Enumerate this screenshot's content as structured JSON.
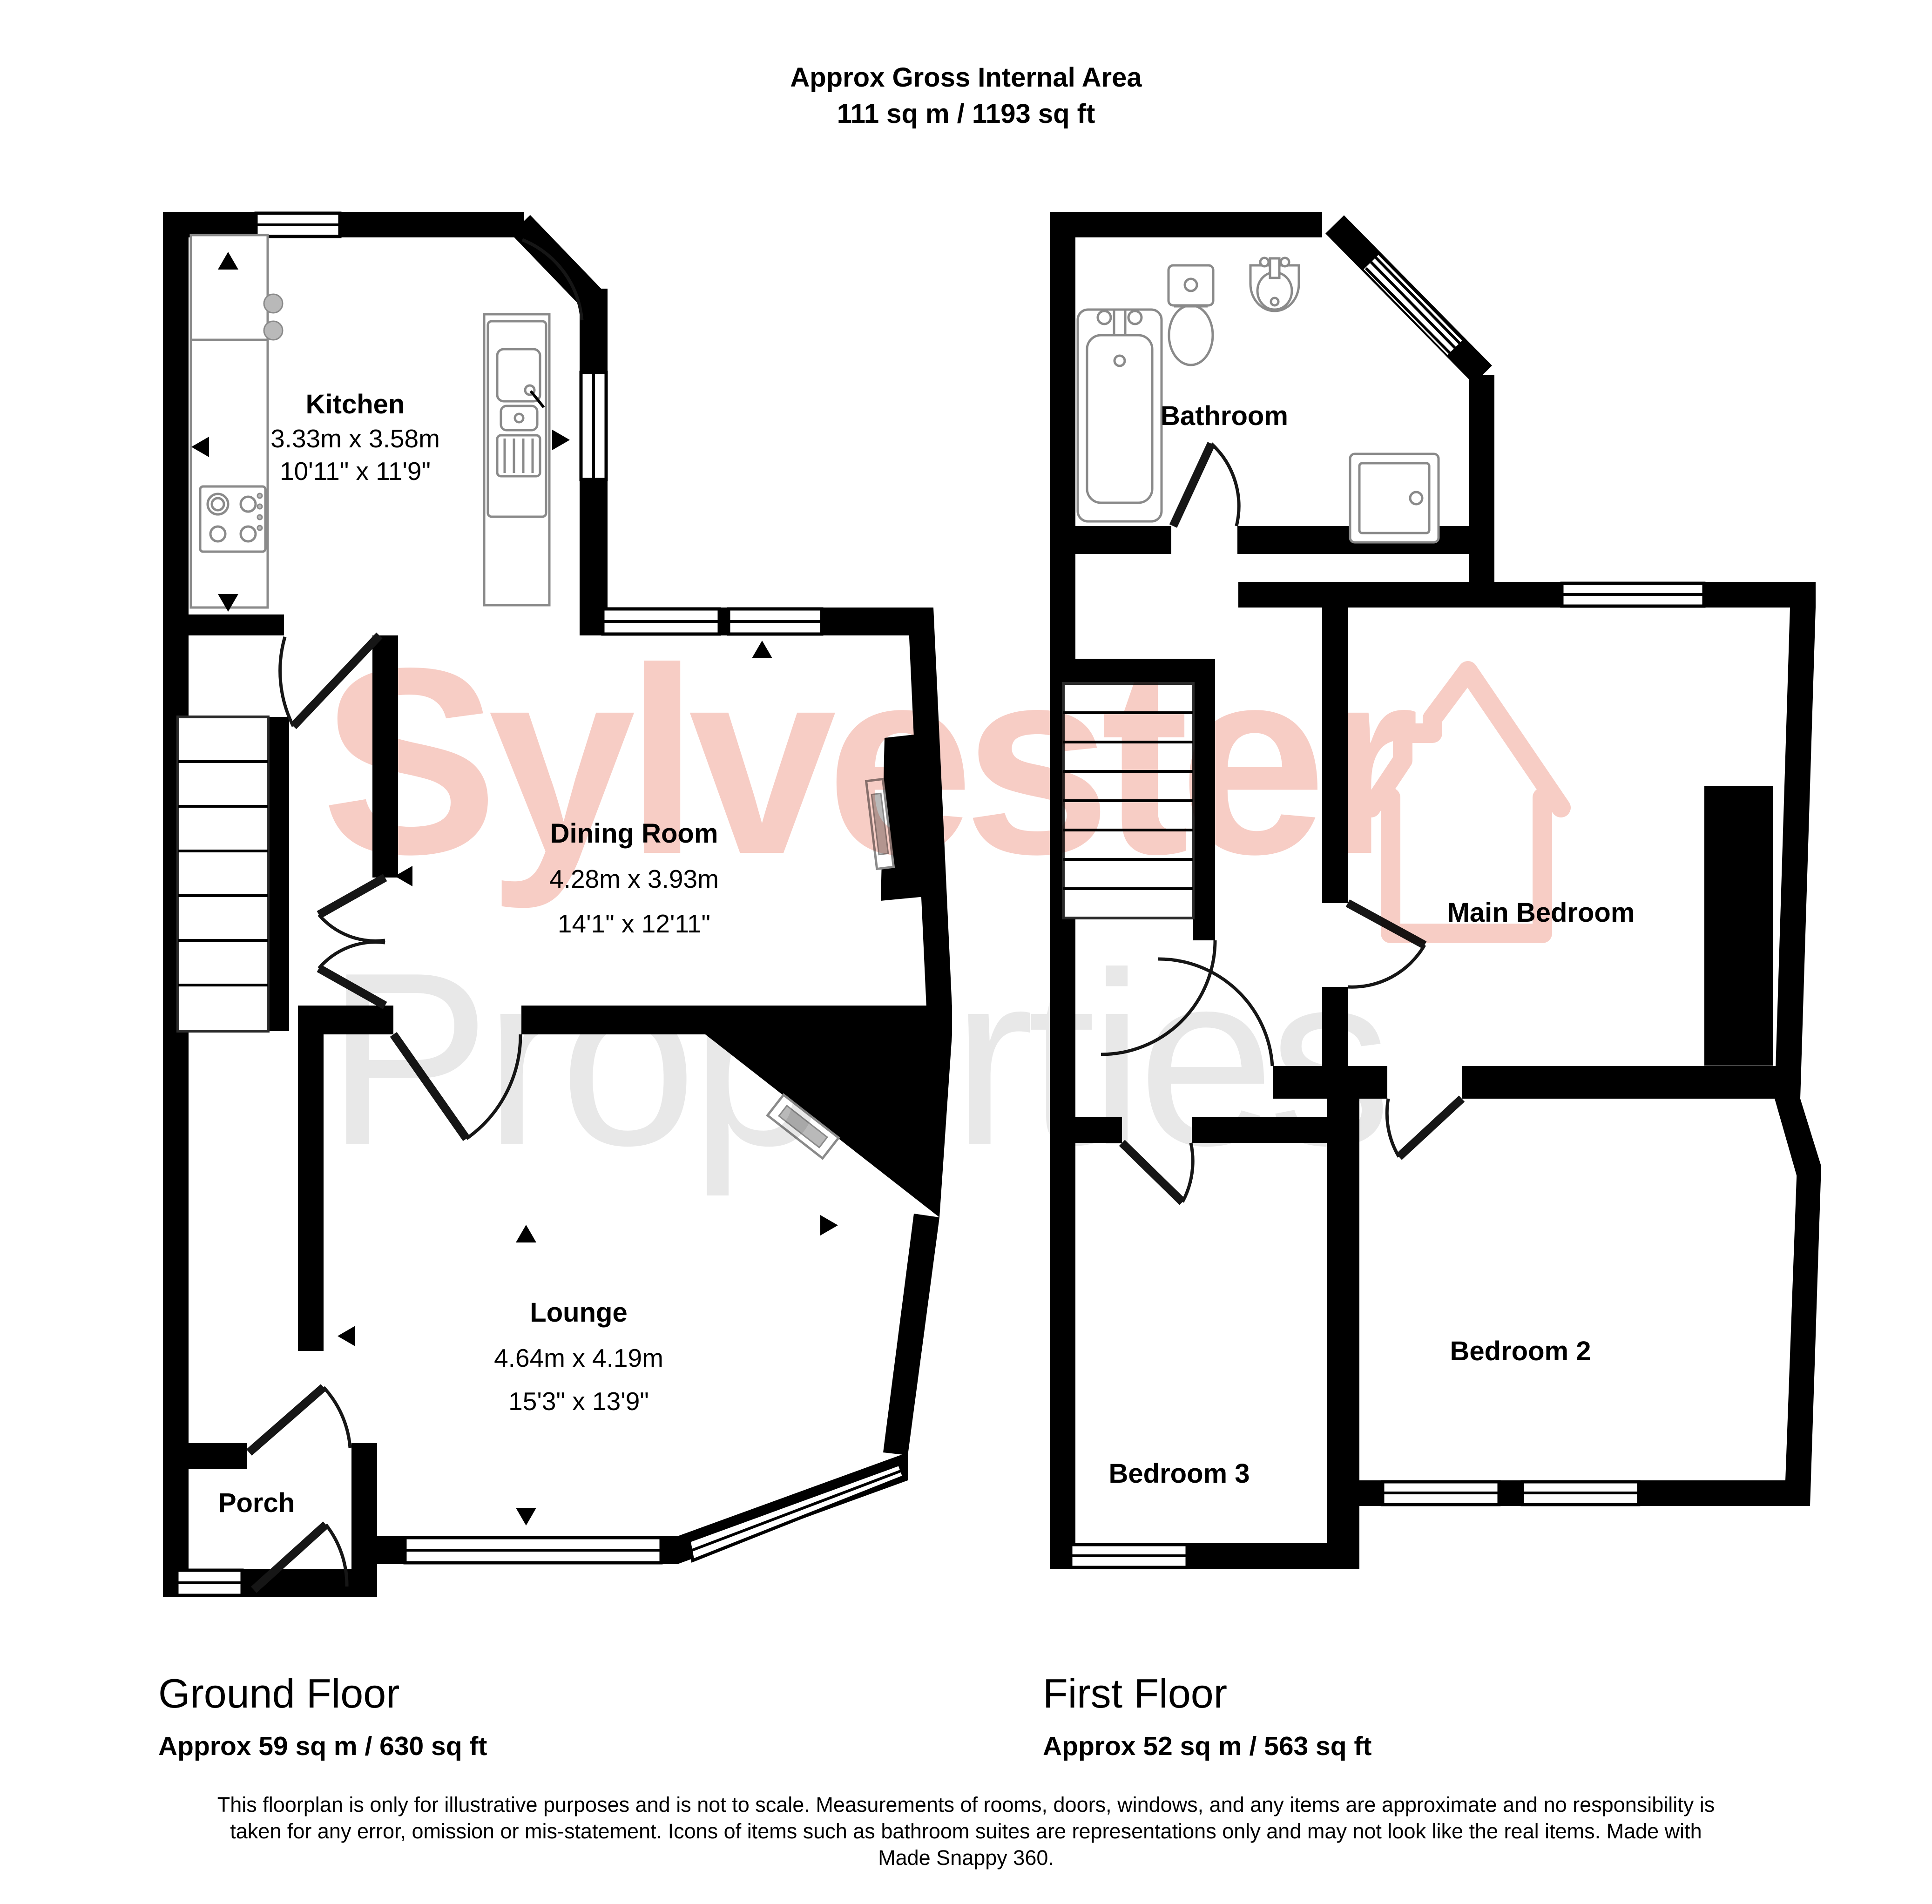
{
  "title": {
    "line1": "Approx Gross Internal Area",
    "line2": "111 sq m / 1193 sq ft"
  },
  "watermark": {
    "line1": "Sylvester",
    "line2": "Properties",
    "icon": "house-outline-icon",
    "accent_color": "#f7cdc5",
    "secondary_color": "#e8e8e8"
  },
  "floors": [
    {
      "name": "Ground Floor",
      "area": "Approx 59 sq m / 630 sq ft",
      "rooms": [
        {
          "name": "Kitchen",
          "dims_m": "3.33m x 3.58m",
          "dims_ft": "10'11\" x 11'9\""
        },
        {
          "name": "Dining Room",
          "dims_m": "4.28m x 3.93m",
          "dims_ft": "14'1\" x 12'11\""
        },
        {
          "name": "Lounge",
          "dims_m": "4.64m x 4.19m",
          "dims_ft": "15'3\" x 13'9\""
        },
        {
          "name": "Porch"
        }
      ]
    },
    {
      "name": "First Floor",
      "area": "Approx 52 sq m / 563 sq ft",
      "rooms": [
        {
          "name": "Bathroom"
        },
        {
          "name": "Main Bedroom"
        },
        {
          "name": "Bedroom 2"
        },
        {
          "name": "Bedroom 3"
        }
      ]
    }
  ],
  "disclaimer": "This floorplan is only for illustrative purposes and is not to scale. Measurements of rooms, doors, windows, and any items are approximate and no responsibility is taken for any error, omission or mis-statement. Icons of items such as bathroom suites are representations only and may not look like the real items. Made with Made Snappy 360."
}
